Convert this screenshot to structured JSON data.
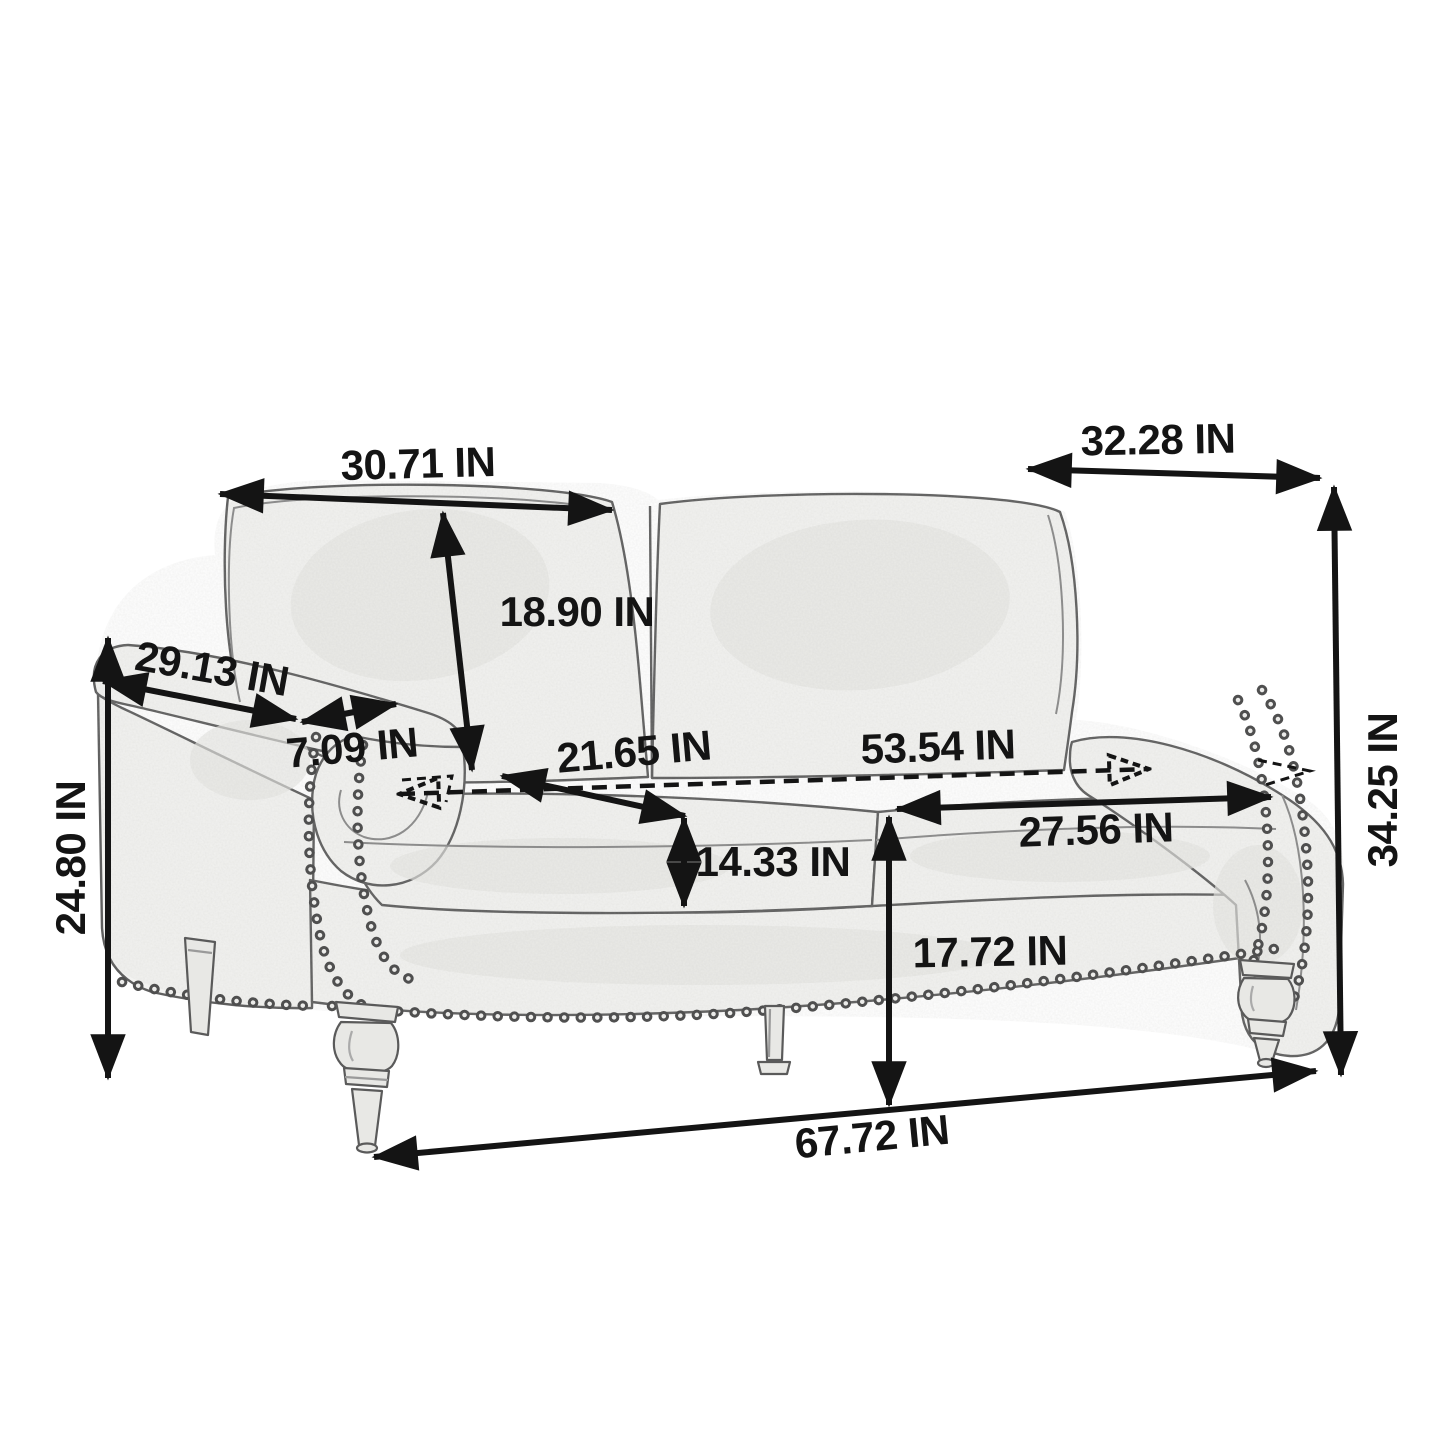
{
  "diagram": {
    "kind": "furniture-dimension-diagram",
    "subject": "loveseat sofa sketch with nailhead trim and turned legs",
    "unit": "IN"
  },
  "dimensions": {
    "back_cushion_width": "30.71 IN",
    "overall_depth": "32.28 IN",
    "back_cushion_height": "18.90 IN",
    "arm_length": "29.13 IN",
    "arm_width": "7.09 IN",
    "seat_depth": "21.65 IN",
    "seat_width": "53.54 IN",
    "seat_cushion_width": "27.56 IN",
    "seat_cushion_thickness": "14.33 IN",
    "seat_height": "17.72 IN",
    "overall_width": "67.72 IN",
    "arm_height": "24.80 IN",
    "overall_height": "34.25 IN"
  },
  "colors": {
    "background": "#ffffff",
    "annotation_ink": "#141414",
    "sketch_line": "#5f5f5f",
    "sketch_fill": "#f3f3f1",
    "sketch_shade": "#e6e6e3"
  }
}
